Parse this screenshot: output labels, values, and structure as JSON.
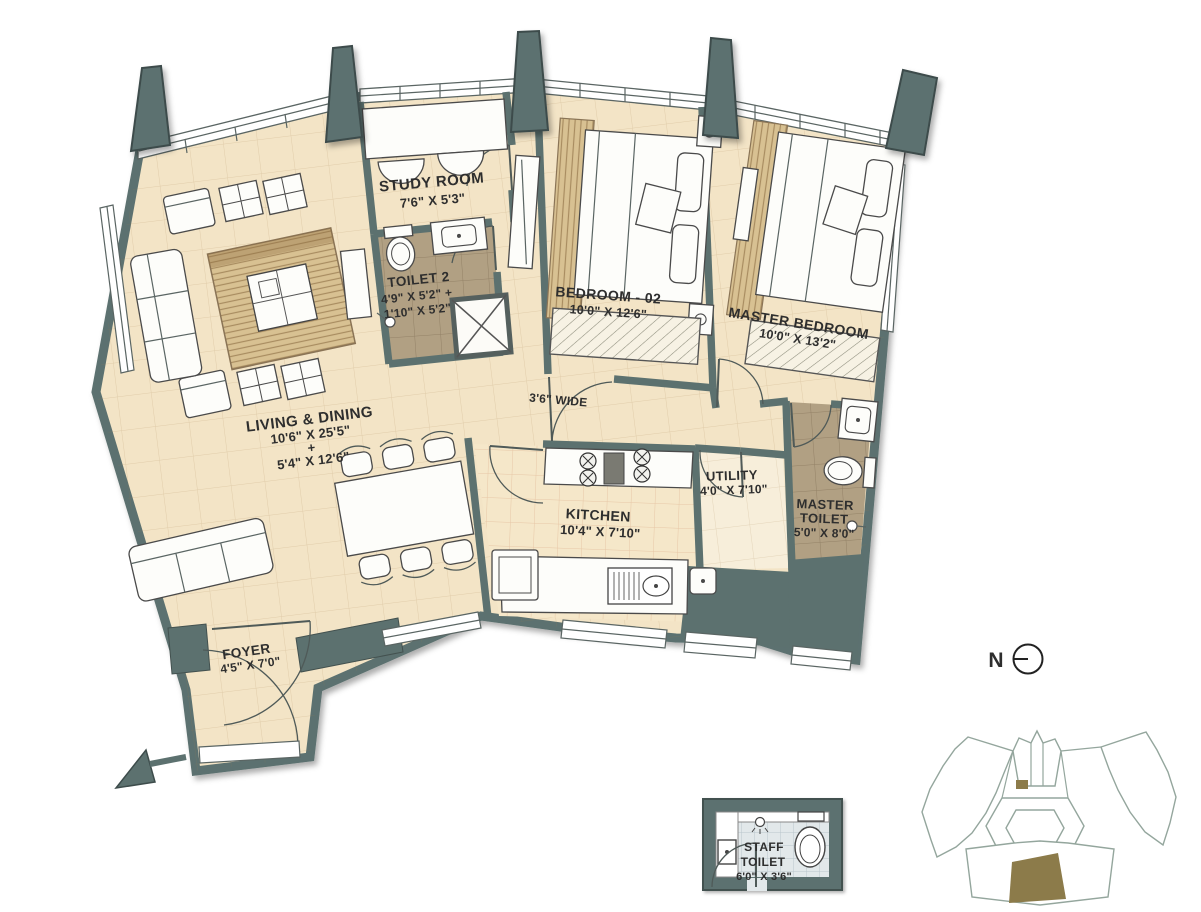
{
  "title": "Apartment unit floor plan",
  "colors": {
    "wall": "#5c716f",
    "wall_outline": "#3d4c4b",
    "floor": "#f3e4c6",
    "kitchen_floor": "#f5e7c9",
    "utility_floor": "#f7eeda",
    "toilet_floor": "#b1a083",
    "rug": "#d8c192",
    "staff_floor": "#e2e8ea",
    "keyplan_line": "#94a69d",
    "unit_highlight": "#8c7b4a",
    "label_text": "#2e2e2e"
  },
  "rooms": {
    "study": {
      "name": "STUDY ROOM",
      "size": "7'6\" X 5'3\""
    },
    "toilet2": {
      "name": "TOILET 2",
      "size_line1": "4'9\" X 5'2\" +",
      "size_line2": "1'10\" X 5'2\""
    },
    "bedroom02": {
      "name": "BEDROOM - 02",
      "size": "10'0\" X 12'6\""
    },
    "master_bedroom": {
      "name": "MASTER BEDROOM",
      "size": "10'0\" X 13'2\""
    },
    "living_dining": {
      "name": "LIVING & DINING",
      "size_line1": "10'6\" X 25'5\"",
      "plus": "+",
      "size_line2": "5'4\" X 12'6\""
    },
    "passage": {
      "name": "3'6\" WIDE"
    },
    "kitchen": {
      "name": "KITCHEN",
      "size": "10'4\" X 7'10\""
    },
    "utility": {
      "name": "UTILITY",
      "size": "4'0\" X 7'10\""
    },
    "master_toilet": {
      "name_line1": "MASTER",
      "name_line2": "TOILET",
      "size": "5'0\" X 8'0\""
    },
    "foyer": {
      "name": "FOYER",
      "size": "4'5\" X 7'0\""
    },
    "staff_toilet": {
      "name_line1": "STAFF",
      "name_line2": "TOILET",
      "size": "6'0\" X 3'6\""
    }
  },
  "compass": {
    "label": "N"
  }
}
